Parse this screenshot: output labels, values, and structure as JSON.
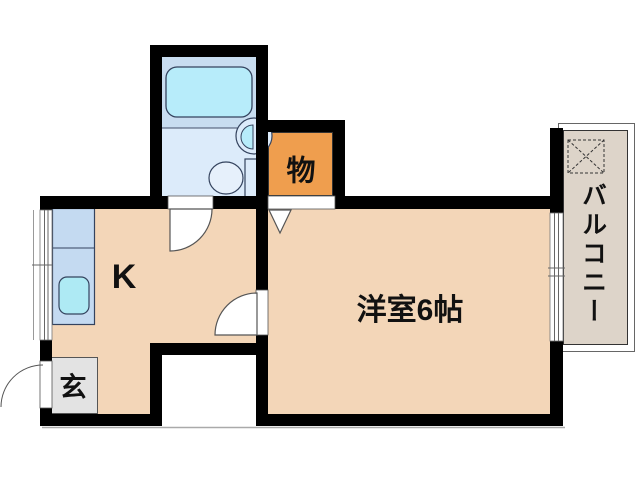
{
  "floor_plan": {
    "type": "apartment-1K-floor-plan",
    "rooms": {
      "kitchen": {
        "label": "K"
      },
      "western_room": {
        "label": "洋室6帖"
      },
      "closet": {
        "label": "物"
      },
      "entrance": {
        "label": "玄"
      },
      "balcony": {
        "label": "バルコニー"
      },
      "bathroom": {
        "label": ""
      }
    },
    "fixtures": [
      "bathtub",
      "bathroom-sink",
      "toilet",
      "kitchen-counter",
      "kitchen-sink",
      "washing-machine-area",
      "entrance-door-swing",
      "bathroom-door-swing",
      "room-door-swing",
      "closet-door-symbol",
      "window-left",
      "window-balcony"
    ],
    "colors": {
      "wall": "#000000",
      "room_floor": "#f3d6b8",
      "closet_fill": "#ef9e4e",
      "entrance_fill": "#e3e3e3",
      "balcony_fill": "#ddd4c9",
      "bath_floor_upper": "#c8ddf0",
      "bath_floor_lower": "#dcebfa",
      "bathtub_fill": "#b7ecfa",
      "kitchen_counter_fill": "#c4daf1",
      "kitchen_sink_fill": "#aeeaf4",
      "outline": "#333333"
    }
  }
}
